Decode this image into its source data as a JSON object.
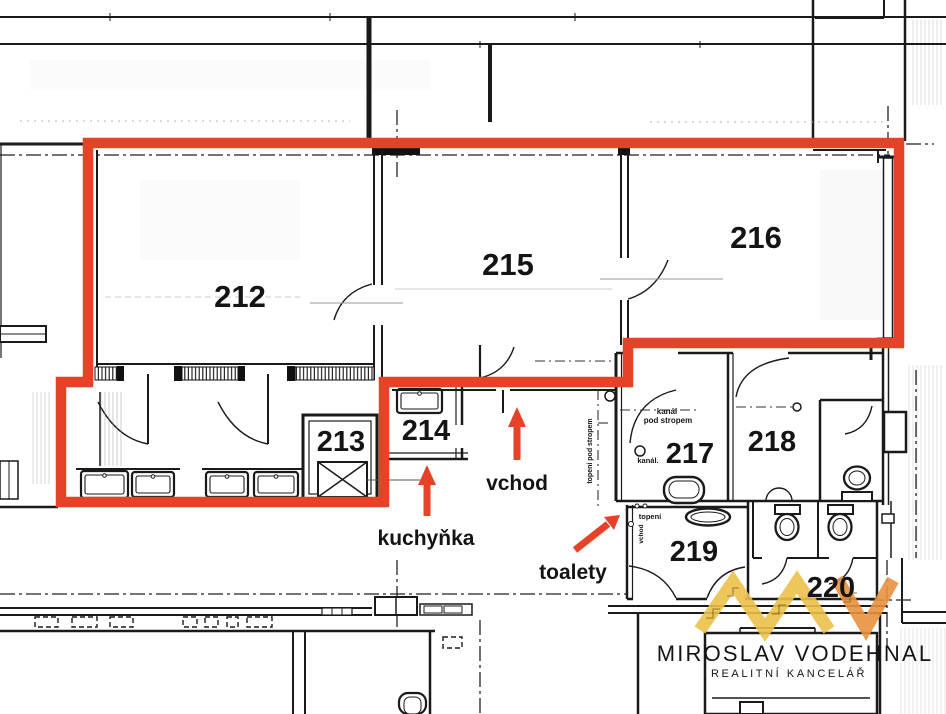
{
  "rooms": {
    "r212": "212",
    "r213": "213",
    "r214": "214",
    "r215": "215",
    "r216": "216",
    "r217": "217",
    "r218": "218",
    "r219": "219",
    "r220": "220"
  },
  "annotations": {
    "entrance": {
      "label": "vchod"
    },
    "kitchenette": {
      "label": "kuchyňka"
    },
    "toilets": {
      "label": "toalety"
    }
  },
  "notes": {
    "duct_line1": "kanál",
    "duct_line2": "pod stropem",
    "duct_short": "kanál.",
    "heating": "topení",
    "heating_ceiling": "topení pod stropem",
    "entrance_small": "vchod"
  },
  "logo": {
    "monogram": "MV",
    "name": "MIROSLAV VODEHNAL",
    "subtitle": "REALITNÍ KANCELÁŘ"
  },
  "colors": {
    "highlight": "#e64228",
    "logo_gold": "#ecc14a",
    "logo_orange": "#e8923e",
    "logo_text": "#4b4b4b",
    "logo_subtext": "#9c9c9c",
    "ink": "#1a1a1a"
  }
}
